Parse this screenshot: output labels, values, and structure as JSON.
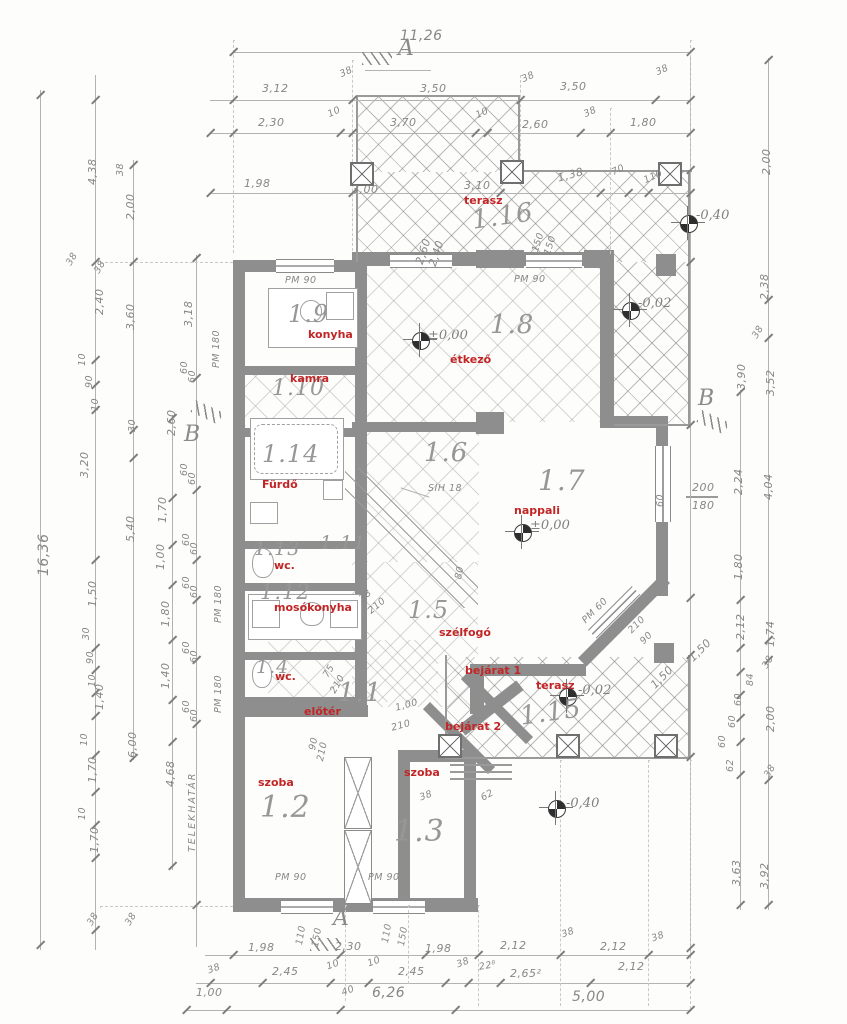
{
  "rooms": [
    {
      "code": "1.16",
      "name": "terasz"
    },
    {
      "code": "1.9",
      "name": "konyha"
    },
    {
      "code": "1.10",
      "name": "kamra"
    },
    {
      "code": "1.8",
      "name": "étkező"
    },
    {
      "code": "1.7",
      "name": "nappali"
    },
    {
      "code": "1.14",
      "name": "Fürdő"
    },
    {
      "code": "1.13",
      "name": "wc."
    },
    {
      "code": "1.11",
      "name": ""
    },
    {
      "code": "1.12",
      "name": "mosókonyha"
    },
    {
      "code": "1.6",
      "name": ""
    },
    {
      "code": "1.5",
      "name": "szélfogó"
    },
    {
      "code": "1.1",
      "name": "előtér"
    },
    {
      "code": "1.4",
      "name": "wc."
    },
    {
      "code": "1.2",
      "name": "szoba"
    },
    {
      "code": "1.3",
      "name": "szoba"
    },
    {
      "code": "1.15",
      "name": "terasz"
    }
  ],
  "entrances": [
    "bejárat 1",
    "bejárat 2"
  ],
  "levels": [
    "±0,00",
    "±0,00",
    "-0,02",
    "-0,40",
    "-0,02",
    "-0,40"
  ],
  "sections": {
    "a": "A",
    "b": "B"
  },
  "callouts": [
    "PM 90",
    "PM 90",
    "PM 60",
    "PM 90",
    "PM 90",
    "SIH 18"
  ],
  "dims": {
    "top": [
      "11,26",
      "3,12",
      "38",
      "3,50",
      "38",
      "3,50",
      "38",
      "2,30",
      "10",
      "3,70",
      "10",
      "2,60",
      "38",
      "1,80",
      "1,98",
      "3,00",
      "3,10",
      "1,38",
      "70",
      "110"
    ],
    "left": [
      "4,38",
      "38",
      "2,00",
      "38",
      "38",
      "2,40",
      "3,60",
      "10",
      "90",
      "10",
      "30",
      "3,20",
      "16,36",
      "3,18",
      "2,60",
      "5,40",
      "6,00",
      "1,50",
      "30",
      "90",
      "10",
      "1,40",
      "10",
      "1,70",
      "10",
      "1,70",
      "38",
      "38",
      "1,70",
      "1,00",
      "1,80",
      "1,40",
      "4,68",
      "TELEKHATÁR",
      "60",
      "60",
      "60",
      "60",
      "60",
      "60",
      "60",
      "60",
      "60",
      "60",
      "60",
      "60",
      "PM 180",
      "PM 180",
      "PM 180"
    ],
    "right": [
      "2,00",
      "2,38",
      "38",
      "3,90",
      "3,52",
      "2,24",
      "4,04",
      "1,80",
      "2,12",
      "1,74",
      "1,50",
      "38",
      "84",
      "60",
      "60",
      "60",
      "2,00",
      "62",
      "38",
      "3,63",
      "3,92",
      "1,50",
      "200",
      "180",
      "60"
    ],
    "bottom": [
      "1,98",
      "2,30",
      "1,98",
      "2,12",
      "38",
      "2,12",
      "38",
      "38",
      "2,45",
      "10",
      "10",
      "2,45",
      "38",
      "22⁸",
      "2,65²",
      "2,12",
      "1,00",
      "40",
      "6,26",
      "5,00"
    ],
    "inner": [
      "110",
      "150",
      "110",
      "150",
      "2,60",
      "2,40",
      "150",
      "150",
      "90",
      "210",
      "75",
      "210",
      "210",
      "38",
      "1,00",
      "210",
      "210",
      "90",
      "62",
      "38",
      "80"
    ]
  }
}
